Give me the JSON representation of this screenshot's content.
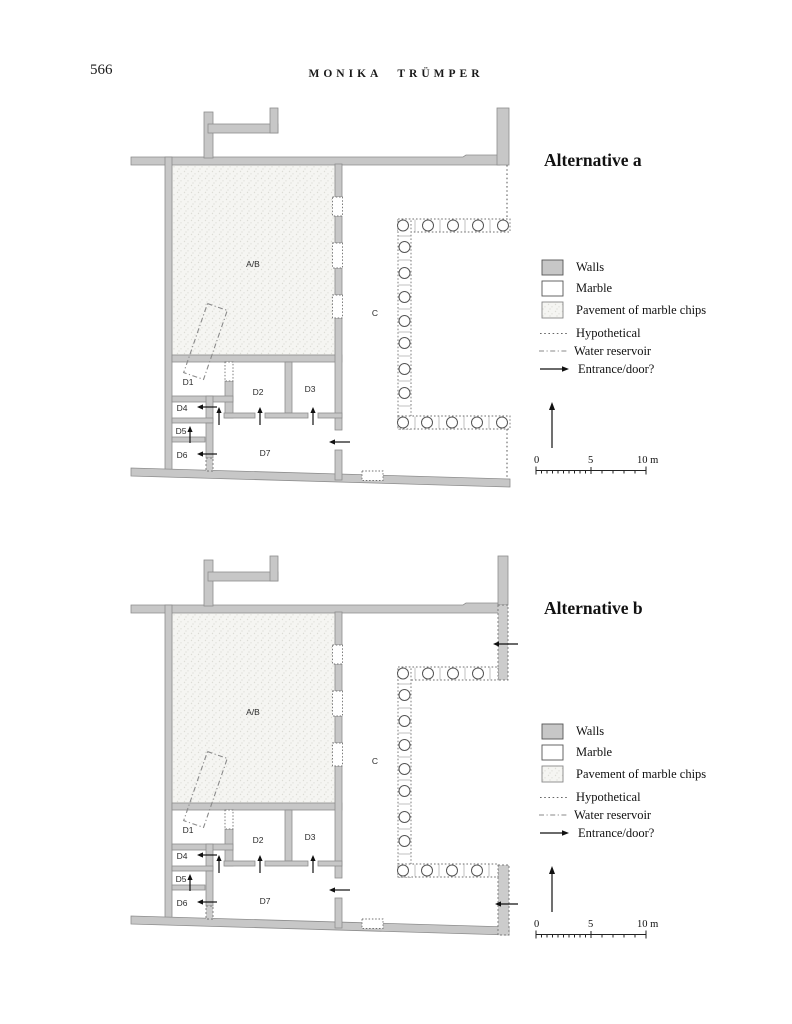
{
  "page": {
    "number": "566",
    "running_head": "MONIKA TRÜMPER"
  },
  "figures": [
    {
      "title": "Alternative a",
      "rooms": {
        "ab": "A/B",
        "c": "C",
        "d1": "D1",
        "d2": "D2",
        "d3": "D3",
        "d4": "D4",
        "d5": "D5",
        "d6": "D6",
        "d7": "D7"
      },
      "legend": {
        "walls": "Walls",
        "marble": "Marble",
        "pavement": "Pavement of marble chips",
        "hypothetical": "Hypothetical",
        "water_reservoir": "Water reservoir",
        "entrance": "Entrance/door?"
      },
      "scale": {
        "start": "0",
        "mid": "5",
        "end": "10 m"
      }
    },
    {
      "title": "Alternative b",
      "rooms": {
        "ab": "A/B",
        "c": "C",
        "d1": "D1",
        "d2": "D2",
        "d3": "D3",
        "d4": "D4",
        "d5": "D5",
        "d6": "D6",
        "d7": "D7"
      },
      "legend": {
        "walls": "Walls",
        "marble": "Marble",
        "pavement": "Pavement of marble chips",
        "hypothetical": "Hypothetical",
        "water_reservoir": "Water reservoir",
        "entrance": "Entrance/door?"
      },
      "scale": {
        "start": "0",
        "mid": "5",
        "end": "10 m"
      }
    }
  ],
  "colors": {
    "wall_fill": "#c7c7c7",
    "wall_stroke": "#8d8d8d",
    "pavement_fill": "#f5f5f2",
    "marble_fill": "#ffffff",
    "ink": "#111111"
  }
}
